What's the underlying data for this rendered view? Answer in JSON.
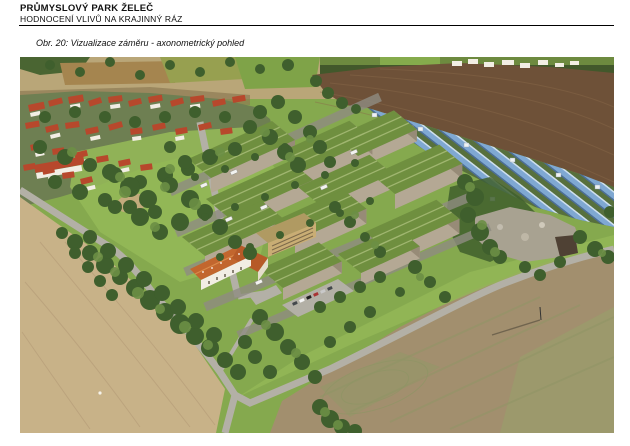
{
  "header": {
    "title": "PRŮMYSLOVÝ PARK ŽELEČ",
    "subtitle": "HODNOCENÍ VLIVŮ NA KRAJINNÝ RÁZ"
  },
  "figure": {
    "caption": "Obr. 20: Vizualizace záměru - axonometrický pohled",
    "alt": "Letecká axonometrická vizualizace průmyslového parku Želeč: haly se zelenými střechami, fotovoltaická elektrárna, obec, pole a komunikace",
    "palette": {
      "page_bg": "#ffffff",
      "meadow_green": "#85a94e",
      "meadow_bright": "#94b858",
      "plowed_brown": "#6e5138",
      "plowed_streak": "#8a6a4a",
      "tan_field": "#c8b288",
      "tan_streak": "#b09673",
      "se_field": "#a28f6e",
      "se_streak": "#8f9565",
      "road_grey": "#b3b0a6",
      "road_dark": "#8f8c82",
      "solar_blue": "#7fa8d2",
      "solar_ground": "#57703d",
      "roof_green": "#6f8f3f",
      "roof_stripe": "#a9bd79",
      "wall_beige": "#b4a894",
      "wall_dark": "#978b77",
      "village_roof": "#b7482c",
      "house_white": "#f2eee4",
      "orange_roof": "#c2662e",
      "tree_dark": "#3f5f2d",
      "tree_light": "#6c8f45",
      "rock_grey": "#a8a291",
      "top_band_tan": "#b9a678"
    },
    "scene": {
      "car_colors": [
        "#f5f5f5",
        "#44484c",
        "#a83434",
        "#3f5e97",
        "#c9c9c9",
        "#202020"
      ],
      "trees_dark": [
        [
          30,
          8,
          5
        ],
        [
          60,
          15,
          5
        ],
        [
          90,
          5,
          5
        ],
        [
          120,
          18,
          5
        ],
        [
          150,
          8,
          5
        ],
        [
          180,
          15,
          5
        ],
        [
          210,
          5,
          5
        ],
        [
          240,
          12,
          5
        ],
        [
          268,
          8,
          6
        ],
        [
          20,
          90,
          7
        ],
        [
          45,
          100,
          8
        ],
        [
          70,
          108,
          7
        ],
        [
          95,
          118,
          8
        ],
        [
          120,
          125,
          7
        ],
        [
          145,
          118,
          8
        ],
        [
          168,
          112,
          7
        ],
        [
          190,
          100,
          8
        ],
        [
          215,
          92,
          7
        ],
        [
          35,
          125,
          7
        ],
        [
          60,
          135,
          8
        ],
        [
          85,
          143,
          7
        ],
        [
          110,
          150,
          7
        ],
        [
          135,
          155,
          7
        ],
        [
          25,
          60,
          6
        ],
        [
          55,
          55,
          6
        ],
        [
          85,
          60,
          6
        ],
        [
          115,
          65,
          6
        ],
        [
          145,
          60,
          6
        ],
        [
          175,
          55,
          6
        ],
        [
          205,
          60,
          6
        ],
        [
          230,
          70,
          7
        ],
        [
          250,
          80,
          8
        ],
        [
          265,
          95,
          8
        ],
        [
          278,
          108,
          8
        ],
        [
          240,
          55,
          7
        ],
        [
          258,
          45,
          7
        ],
        [
          275,
          60,
          7
        ],
        [
          290,
          75,
          7
        ],
        [
          300,
          90,
          7
        ],
        [
          310,
          105,
          6
        ],
        [
          296,
          24,
          6
        ],
        [
          308,
          36,
          6
        ],
        [
          322,
          46,
          6
        ],
        [
          336,
          52,
          5
        ],
        [
          55,
          185,
          8
        ],
        [
          70,
          196,
          8
        ],
        [
          85,
          208,
          9
        ],
        [
          100,
          220,
          8
        ],
        [
          115,
          231,
          9
        ],
        [
          130,
          243,
          10
        ],
        [
          145,
          255,
          9
        ],
        [
          160,
          267,
          10
        ],
        [
          175,
          279,
          9
        ],
        [
          190,
          291,
          9
        ],
        [
          205,
          303,
          8
        ],
        [
          218,
          315,
          8
        ],
        [
          70,
          180,
          7
        ],
        [
          88,
          194,
          8
        ],
        [
          106,
          208,
          8
        ],
        [
          124,
          222,
          8
        ],
        [
          142,
          236,
          8
        ],
        [
          158,
          250,
          8
        ],
        [
          176,
          264,
          8
        ],
        [
          194,
          278,
          8
        ],
        [
          42,
          176,
          6
        ],
        [
          55,
          196,
          6
        ],
        [
          68,
          210,
          6
        ],
        [
          80,
          224,
          6
        ],
        [
          92,
          238,
          6
        ],
        [
          90,
          115,
          8
        ],
        [
          110,
          130,
          10
        ],
        [
          128,
          142,
          9
        ],
        [
          150,
          128,
          8
        ],
        [
          170,
          142,
          9
        ],
        [
          185,
          155,
          8
        ],
        [
          160,
          165,
          9
        ],
        [
          140,
          175,
          8
        ],
        [
          120,
          160,
          9
        ],
        [
          200,
          170,
          8
        ],
        [
          95,
          150,
          7
        ],
        [
          215,
          185,
          7
        ],
        [
          230,
          196,
          7
        ],
        [
          150,
          90,
          6
        ],
        [
          165,
          105,
          7
        ],
        [
          175,
          120,
          4
        ],
        [
          205,
          112,
          4
        ],
        [
          235,
          100,
          4
        ],
        [
          265,
          90,
          4
        ],
        [
          185,
          160,
          4
        ],
        [
          215,
          150,
          4
        ],
        [
          245,
          140,
          4
        ],
        [
          275,
          128,
          4
        ],
        [
          305,
          118,
          4
        ],
        [
          335,
          106,
          4
        ],
        [
          200,
          200,
          4
        ],
        [
          230,
          190,
          4
        ],
        [
          260,
          178,
          4
        ],
        [
          290,
          166,
          4
        ],
        [
          320,
          156,
          4
        ],
        [
          350,
          144,
          4
        ],
        [
          240,
          260,
          8
        ],
        [
          255,
          275,
          9
        ],
        [
          268,
          290,
          8
        ],
        [
          282,
          305,
          8
        ],
        [
          295,
          320,
          7
        ],
        [
          250,
          315,
          7
        ],
        [
          235,
          300,
          7
        ],
        [
          225,
          285,
          7
        ],
        [
          300,
          250,
          6
        ],
        [
          320,
          240,
          6
        ],
        [
          340,
          230,
          6
        ],
        [
          360,
          220,
          6
        ],
        [
          380,
          235,
          5
        ],
        [
          350,
          255,
          6
        ],
        [
          330,
          270,
          6
        ],
        [
          310,
          285,
          6
        ],
        [
          315,
          150,
          6
        ],
        [
          330,
          165,
          6
        ],
        [
          345,
          180,
          5
        ],
        [
          360,
          195,
          6
        ],
        [
          395,
          210,
          7
        ],
        [
          410,
          225,
          6
        ],
        [
          425,
          240,
          6
        ],
        [
          445,
          125,
          8
        ],
        [
          455,
          140,
          9
        ],
        [
          448,
          158,
          8
        ],
        [
          460,
          175,
          9
        ],
        [
          470,
          190,
          8
        ],
        [
          480,
          200,
          7
        ],
        [
          560,
          180,
          7
        ],
        [
          575,
          192,
          8
        ],
        [
          588,
          200,
          7
        ],
        [
          590,
          155,
          6
        ],
        [
          300,
          350,
          8
        ],
        [
          310,
          362,
          9
        ],
        [
          322,
          370,
          8
        ],
        [
          335,
          374,
          7
        ],
        [
          505,
          210,
          6
        ],
        [
          520,
          218,
          6
        ],
        [
          540,
          205,
          6
        ]
      ],
      "trees_light": [
        [
          78,
          200,
          5
        ],
        [
          95,
          215,
          5
        ],
        [
          118,
          236,
          6
        ],
        [
          140,
          252,
          5
        ],
        [
          165,
          270,
          6
        ],
        [
          188,
          288,
          5
        ],
        [
          105,
          135,
          6
        ],
        [
          145,
          130,
          5
        ],
        [
          175,
          147,
          6
        ],
        [
          135,
          170,
          5
        ],
        [
          450,
          130,
          5
        ],
        [
          462,
          168,
          5
        ],
        [
          475,
          195,
          5
        ],
        [
          305,
          355,
          5
        ],
        [
          318,
          368,
          5
        ],
        [
          52,
          95,
          5
        ],
        [
          100,
          120,
          5
        ],
        [
          150,
          112,
          5
        ],
        [
          200,
          95,
          5
        ],
        [
          245,
          75,
          5
        ],
        [
          270,
          100,
          5
        ],
        [
          290,
          82,
          4
        ],
        [
          582,
          196,
          4
        ],
        [
          335,
          158,
          4
        ],
        [
          355,
          188,
          4
        ],
        [
          400,
          220,
          4
        ],
        [
          246,
          268,
          5
        ],
        [
          276,
          296,
          5
        ]
      ],
      "houses": [
        [
          8,
          48,
          16,
          7,
          -12
        ],
        [
          28,
          44,
          14,
          6,
          -15
        ],
        [
          48,
          40,
          15,
          7,
          -10
        ],
        [
          68,
          44,
          13,
          6,
          -18
        ],
        [
          88,
          40,
          14,
          6,
          -8
        ],
        [
          108,
          44,
          13,
          6,
          -14
        ],
        [
          128,
          40,
          14,
          6,
          -10
        ],
        [
          150,
          44,
          13,
          6,
          -16
        ],
        [
          170,
          40,
          14,
          6,
          -8
        ],
        [
          192,
          44,
          13,
          6,
          -12
        ],
        [
          212,
          40,
          13,
          6,
          -10
        ],
        [
          5,
          66,
          14,
          6,
          -10
        ],
        [
          25,
          70,
          13,
          6,
          -14
        ],
        [
          45,
          66,
          14,
          6,
          -8
        ],
        [
          65,
          72,
          13,
          6,
          -12
        ],
        [
          88,
          68,
          14,
          6,
          -16
        ],
        [
          110,
          72,
          12,
          6,
          -8
        ],
        [
          132,
          68,
          13,
          6,
          -12
        ],
        [
          155,
          72,
          12,
          6,
          -10
        ],
        [
          178,
          68,
          13,
          6,
          -14
        ],
        [
          200,
          72,
          12,
          6,
          -8
        ],
        [
          10,
          88,
          13,
          6,
          -12
        ],
        [
          32,
          92,
          12,
          6,
          -8
        ],
        [
          54,
          96,
          13,
          6,
          -14
        ],
        [
          76,
          100,
          12,
          6,
          -10
        ],
        [
          98,
          104,
          12,
          6,
          -12
        ],
        [
          120,
          108,
          12,
          6,
          -8
        ],
        [
          3,
          108,
          12,
          6,
          -10
        ],
        [
          22,
          112,
          12,
          6,
          -12
        ],
        [
          42,
          116,
          12,
          6,
          -8
        ],
        [
          60,
          122,
          12,
          6,
          -14
        ],
        [
          14,
          108,
          50,
          8,
          -10
        ]
      ],
      "house_walls": [
        [
          10,
          56,
          10,
          4,
          -12
        ],
        [
          50,
          48,
          10,
          4,
          -10
        ],
        [
          90,
          48,
          10,
          4,
          -8
        ],
        [
          130,
          48,
          10,
          4,
          -10
        ],
        [
          170,
          48,
          10,
          4,
          -8
        ],
        [
          30,
          78,
          10,
          4,
          -14
        ],
        [
          70,
          80,
          10,
          4,
          -12
        ],
        [
          112,
          80,
          9,
          4,
          -8
        ],
        [
          155,
          80,
          9,
          4,
          -10
        ],
        [
          15,
          96,
          9,
          4,
          -12
        ],
        [
          58,
          104,
          9,
          4,
          -14
        ],
        [
          100,
          112,
          9,
          4,
          -12
        ],
        [
          28,
          120,
          9,
          4,
          -12
        ],
        [
          66,
          130,
          9,
          4,
          -14
        ],
        [
          16,
          116,
          46,
          6,
          -10
        ]
      ],
      "horizon_houses": [
        [
          432,
          4,
          10,
          5
        ],
        [
          448,
          2,
          10,
          5
        ],
        [
          464,
          5,
          10,
          5
        ],
        [
          482,
          3,
          12,
          5
        ],
        [
          500,
          6,
          10,
          5
        ],
        [
          518,
          3,
          10,
          5
        ],
        [
          535,
          6,
          9,
          4
        ],
        [
          550,
          4,
          9,
          4
        ]
      ],
      "warehouses": [
        [
          168,
          102,
          1
        ],
        [
          258,
          96,
          0.85
        ],
        [
          315,
          80,
          0.7
        ],
        [
          186,
          142,
          1
        ],
        [
          278,
          130,
          0.85
        ],
        [
          352,
          118,
          0.8
        ],
        [
          162,
          180,
          0.95
        ],
        [
          252,
          165,
          0.85
        ],
        [
          345,
          175,
          0.85
        ],
        [
          240,
          212,
          0.7
        ],
        [
          318,
          197,
          0.7
        ]
      ],
      "cars": [
        [
          258,
          222,
          0
        ],
        [
          265,
          219,
          1
        ],
        [
          272,
          216,
          2
        ],
        [
          279,
          213,
          4
        ],
        [
          286,
          210,
          3
        ],
        [
          293,
          207,
          0
        ],
        [
          300,
          204,
          1
        ],
        [
          272,
          246,
          1
        ],
        [
          279,
          243,
          0
        ],
        [
          286,
          240,
          5
        ],
        [
          293,
          237,
          2
        ],
        [
          300,
          234,
          4
        ],
        [
          307,
          231,
          1
        ]
      ],
      "trucks": [
        [
          180,
          128
        ],
        [
          210,
          115
        ],
        [
          240,
          150
        ],
        [
          300,
          130
        ],
        [
          330,
          95
        ],
        [
          270,
          185
        ],
        [
          205,
          162
        ],
        [
          235,
          225
        ]
      ],
      "solar_boxes": [
        [
          352,
          56
        ],
        [
          398,
          70
        ],
        [
          444,
          86
        ],
        [
          490,
          101
        ],
        [
          536,
          116
        ],
        [
          575,
          128
        ],
        [
          420,
          120
        ],
        [
          470,
          140
        ]
      ]
    }
  }
}
